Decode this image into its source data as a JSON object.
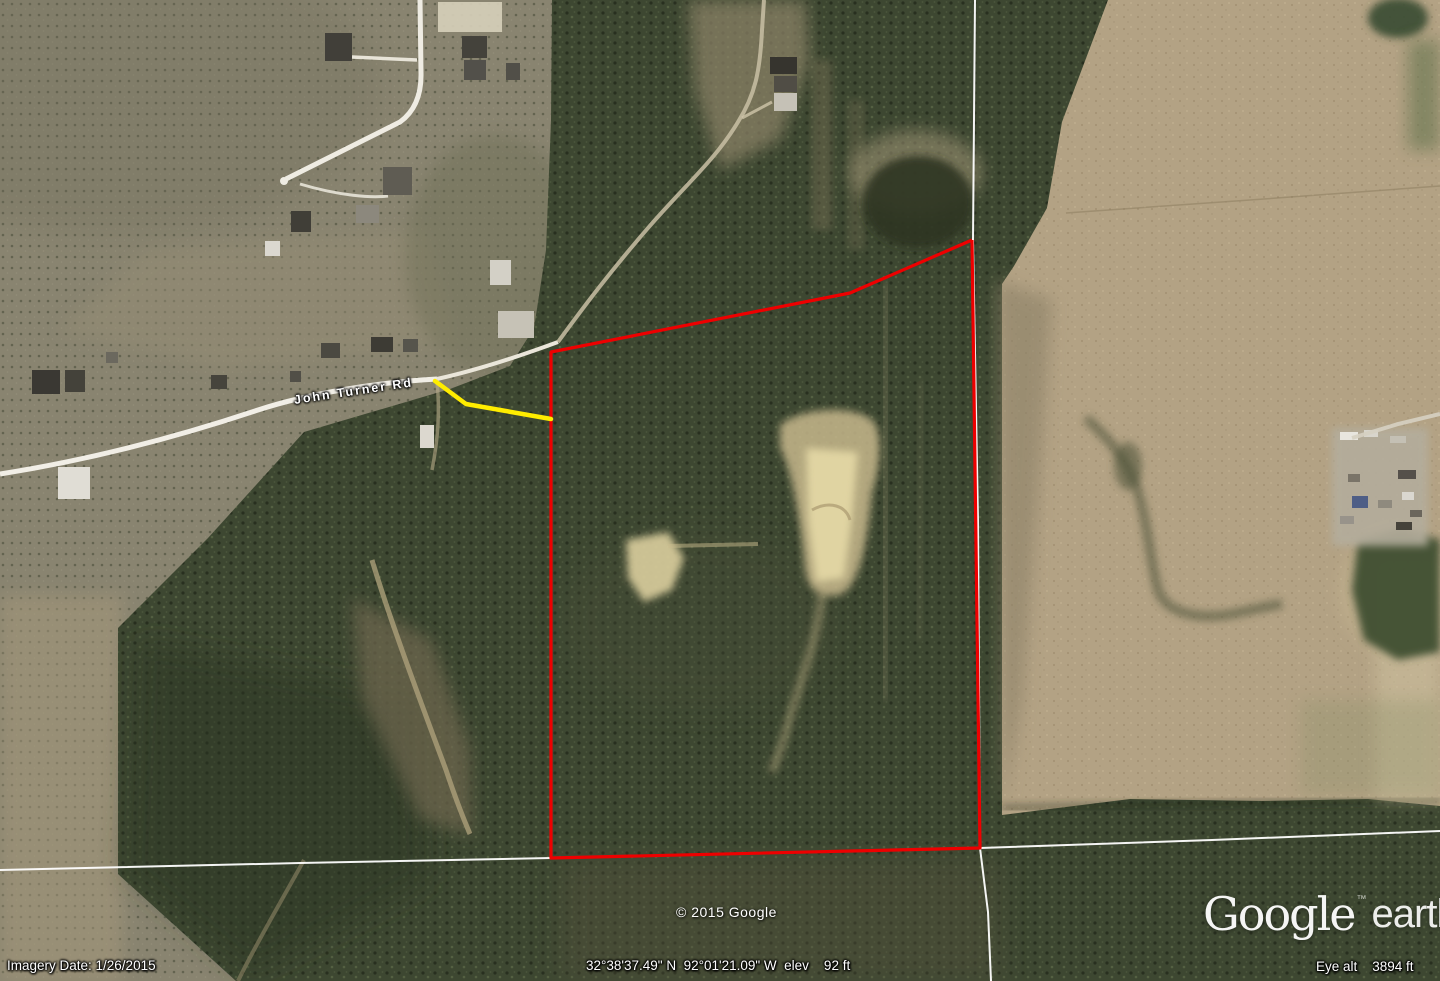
{
  "app": "Google Earth",
  "overlays": {
    "road_label": "John Turner Rd",
    "copyright": "© 2015 Google",
    "logo": {
      "google": "Google",
      "trademark": "™",
      "earth": "earth"
    },
    "status": {
      "imagery_date": "Imagery Date: 1/26/2015",
      "coordinates": "32°38'37.49\" N  92°01'21.09\" W  elev    92 ft",
      "eye_altitude": "Eye alt    3894 ft"
    }
  },
  "annotations": {
    "parcel_outline": {
      "color": "#ee0000",
      "points": [
        [
          972,
          240
        ],
        [
          850,
          293
        ],
        [
          551,
          352
        ],
        [
          551,
          858
        ],
        [
          980,
          848
        ],
        [
          972,
          240
        ]
      ]
    },
    "measure_path": {
      "color": "#ffec00",
      "points": [
        [
          435,
          381
        ],
        [
          466,
          404
        ],
        [
          551,
          419
        ]
      ]
    },
    "boundary_lines": {
      "color": "#ffffff",
      "segments": [
        [
          [
            975,
            0
          ],
          [
            973,
            240
          ],
          [
            978,
            520
          ],
          [
            980,
            848
          ]
        ],
        [
          [
            0,
            870
          ],
          [
            300,
            863
          ],
          [
            551,
            858
          ],
          [
            760,
            853
          ],
          [
            980,
            848
          ]
        ],
        [
          [
            980,
            848
          ],
          [
            1212,
            840
          ],
          [
            1440,
            831
          ]
        ],
        [
          [
            980,
            848
          ],
          [
            988,
            912
          ],
          [
            991,
            981
          ]
        ]
      ]
    }
  }
}
